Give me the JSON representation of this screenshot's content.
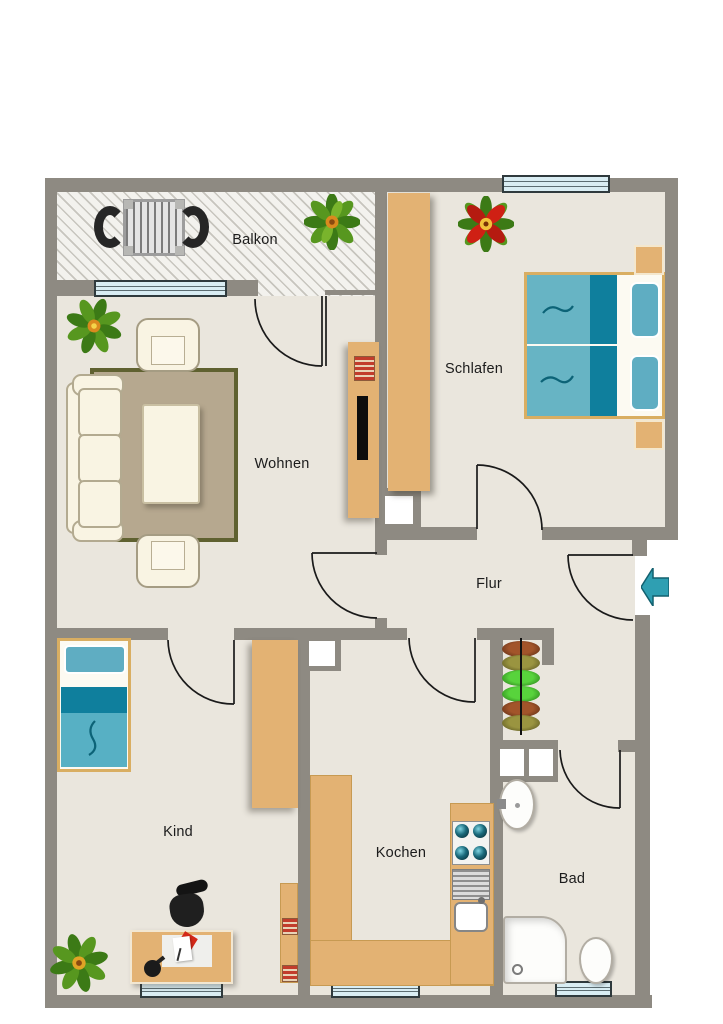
{
  "plan_title": "Apartment floor plan",
  "rooms": [
    {
      "id": "balkon",
      "label": "Balkon",
      "furniture": [
        "dining-table",
        "chair",
        "chair",
        "plant"
      ]
    },
    {
      "id": "wohnen",
      "label": "Wohnen",
      "furniture": [
        "sofa",
        "armchair",
        "armchair",
        "coffee-table",
        "rug",
        "tv-sideboard",
        "plant"
      ]
    },
    {
      "id": "schlafen",
      "label": "Schlafen",
      "furniture": [
        "double-bed",
        "nightstand",
        "nightstand",
        "wardrobe",
        "flower"
      ]
    },
    {
      "id": "flur",
      "label": "Flur",
      "furniture": [
        "plant-shelf",
        "entrance-arrow"
      ]
    },
    {
      "id": "kind",
      "label": "Kind",
      "furniture": [
        "single-bed",
        "wardrobe",
        "bookshelf",
        "desk",
        "desk-chair",
        "plant"
      ]
    },
    {
      "id": "kochen",
      "label": "Kochen",
      "furniture": [
        "kitchen-counter",
        "stove",
        "sink"
      ]
    },
    {
      "id": "bad",
      "label": "Bad",
      "furniture": [
        "washbasin",
        "shower",
        "toilet"
      ]
    }
  ],
  "icons": {
    "entrance_arrow": "left-arrow",
    "plants": [
      "green-plant",
      "red-flower"
    ]
  },
  "colors": {
    "wall": "#8e8a82",
    "floor": "#eae6dd",
    "wood": "#e3b273",
    "teal_dark": "#0f7f9d",
    "teal_light": "#67b4c4",
    "window_glass": "#d9edf3",
    "rug": "#b6a88f",
    "rug_border": "#5f6130",
    "cream_furniture": "#f9f4e3",
    "entrance_arrow": "#2f9fb2"
  },
  "counts": {
    "windows": 5,
    "doors": 7
  }
}
